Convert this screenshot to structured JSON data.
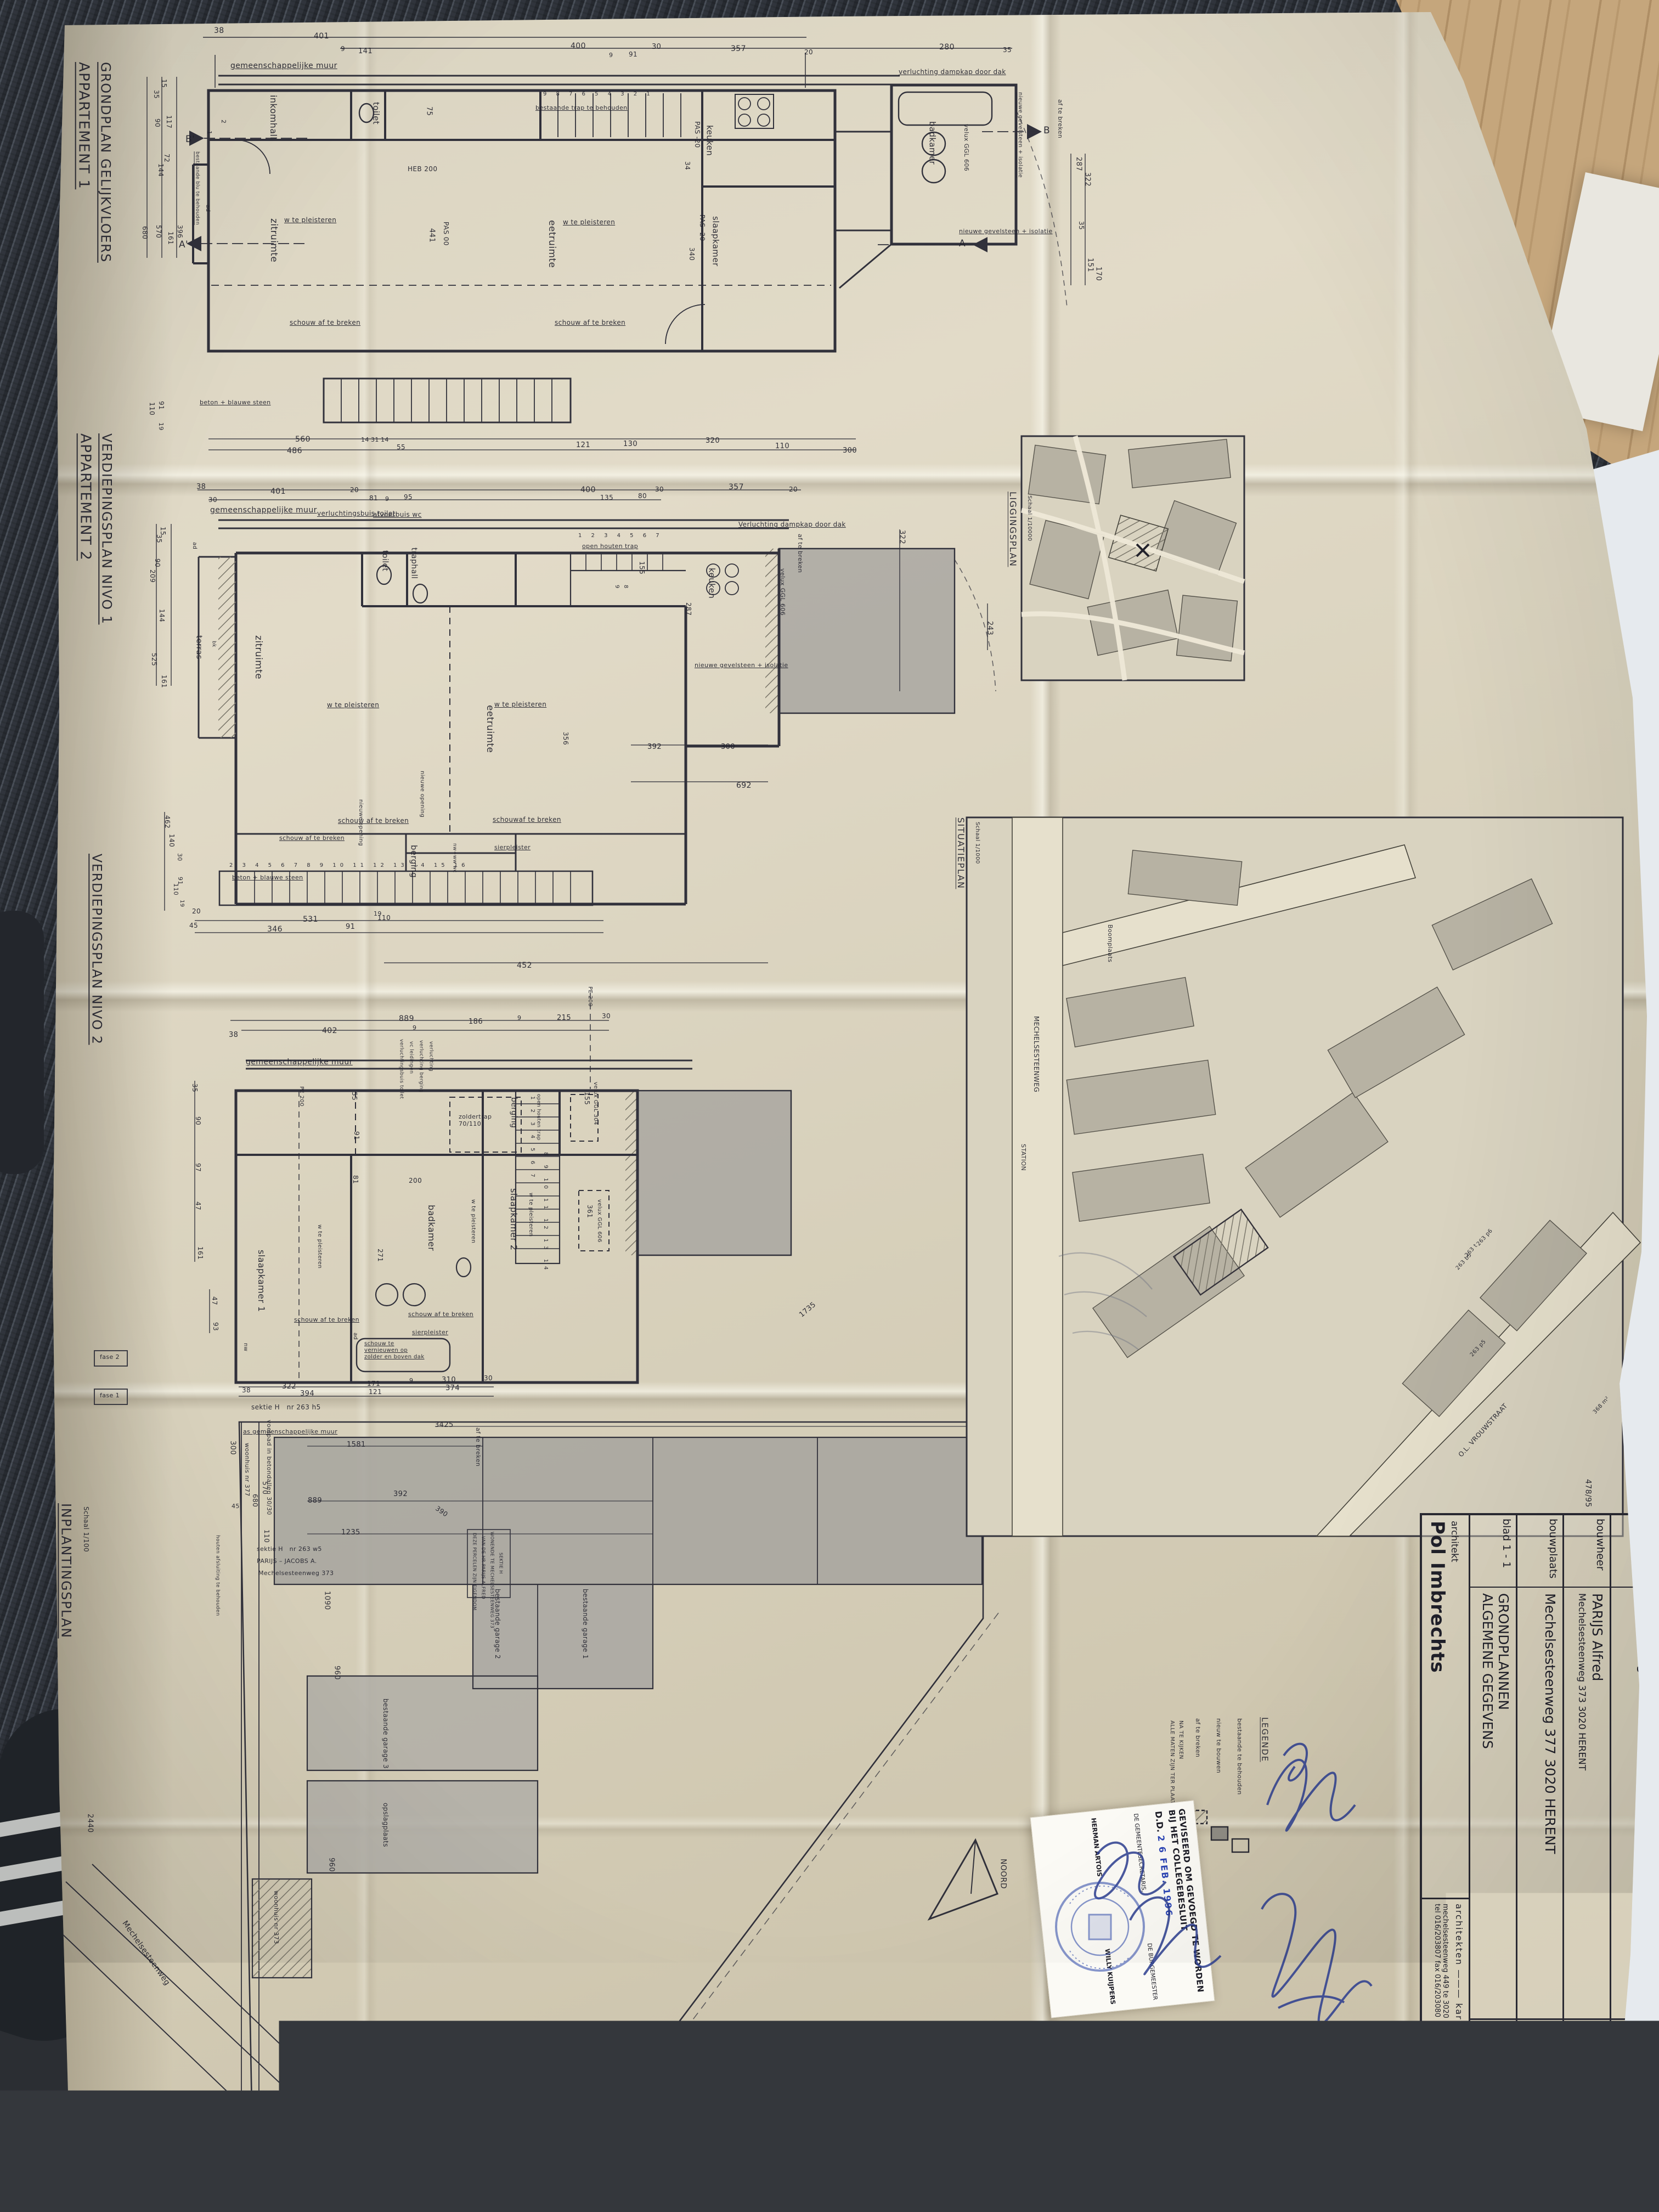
{
  "ap1": {
    "title1": "APPARTEMENT 1",
    "title2": "GRONDPLAN GELIJKVLOERS",
    "labels": {
      "muur": "gemeenschappelijke muur",
      "inkomhall": "inkomhall",
      "toilet": "toilet",
      "zitruimte": "zitruimte",
      "eetruimte": "eetruimte",
      "keuken": "keuken",
      "slaapkamer": "slaapkamer",
      "badkamer": "badkamer",
      "wtp1": "w te pleisteren",
      "wtp2": "w te pleisteren",
      "schouw1": "schouw af te breken",
      "schouw2": "schouw af te breken",
      "trapnote": "bestaande trap te behouden",
      "stairdigits": "9 8 7 6 5 4 3 2 1",
      "heb": "HEB 200",
      "pas00": "PAS 00",
      "pas20a": "PAS -20",
      "pas20b": "PAS -20",
      "verlucht": "verluchting dampkap door dak",
      "velux": "velux GGL 606",
      "ngi1": "nieuwe gevelsteen + isolatie",
      "ngi2": "nieuwe gevelsteen + isolatie",
      "aft": "af te breken",
      "beton": "beton + blauwe steen",
      "bestblu": "bestaande blu te behouden",
      "ad": "ad",
      "mB1": "B'",
      "mB2": "B",
      "mA1": "A'",
      "mA2": "A",
      "n1": "1",
      "n2": "2",
      "d75": "75",
      "d441": "441",
      "d340": "340",
      "d34": "34",
      "t38": "38",
      "t401": "401",
      "t9a": "9",
      "t141": "141",
      "t400": "400",
      "t30": "30",
      "t91": "91",
      "t9b": "9",
      "t357": "357",
      "t20": "20",
      "t280": "280",
      "t35": "35",
      "l15": "15",
      "l35": "35",
      "l90": "90",
      "l117": "117",
      "l72": "72",
      "l144": "144",
      "l396": "396",
      "l161": "161",
      "l570": "570",
      "l680": "680",
      "l110": "110",
      "l91": "91",
      "l19": "19",
      "b560": "560",
      "b486": "486",
      "b14a": "14",
      "b31": "31",
      "b14b": "14",
      "b55": "55",
      "b121": "121",
      "b130": "130",
      "b320": "320",
      "b110": "110",
      "b300": "300",
      "r287": "287",
      "r322": "322",
      "r35": "35",
      "r151": "151",
      "r170": "170"
    }
  },
  "nivo1": {
    "title1": "APPARTEMENT 2",
    "title2": "VERDIEPINGSPLAN NIVO 1",
    "labels": {
      "muur": "gemeenschappelijke muur",
      "vbt": "verluchtingsbuis toilet",
      "avw": "afvoerbuis wc",
      "terras": "terras",
      "zitruimte": "zitruimte",
      "eetruimte": "eetruimte",
      "toilet": "toilet",
      "traphall": "traphall",
      "keuken": "keuken",
      "berging": "berging",
      "wtp1": "w te pleisteren",
      "wtp2": "w te pleisteren",
      "opentrap": "open houten trap",
      "s17": "1 2 3 4 5 6 7",
      "s8": "8",
      "s9": "9",
      "verlucht": "Verluchting dampkap door dak",
      "velux": "velux GGL 606",
      "aft": "af te breken",
      "ngi": "nieuwe gevelsteen + isolatie",
      "sier": "sierpleister",
      "schouw1": "schouw af te breken",
      "schouw2": "schouwaf te breken",
      "schouw3": "schouw af te breken",
      "nop1": "nieuwe opening",
      "nop2": "nieuwe opening",
      "nwww": "nw+ww wc",
      "beton": "beton + blauwe steen",
      "s216": "2 3 4 5 6 7 8 9 10 11 12 13 14 15 16",
      "ad": "ad",
      "bk": "bk",
      "d155": "155",
      "d287": "287",
      "d356": "356",
      "t38": "38",
      "t30a": "30",
      "t401": "401",
      "t20a": "20",
      "t81": "81",
      "t9a": "9",
      "t95": "95",
      "t400": "400",
      "t135": "135",
      "t80": "80",
      "t30b": "30",
      "t357": "357",
      "t20b": "20",
      "l15": "15",
      "l35": "35",
      "l90": "90",
      "l209": "209",
      "l144": "144",
      "l525": "525",
      "l161": "161",
      "l462": "462",
      "l140": "140",
      "l30": "30",
      "l91": "91",
      "l110": "110",
      "l19": "19",
      "b20": "20",
      "b45": "45",
      "b531": "531",
      "b346": "346",
      "b91": "91",
      "b19": "19",
      "b110": "110",
      "b452": "452",
      "b392": "392",
      "b300": "300",
      "b692": "692",
      "r322": "322",
      "r243": "243"
    }
  },
  "nivo2": {
    "title1": "VERDIEPINGSPLAN NIVO 2",
    "labels": {
      "muur": "gemeenschappelijke muur",
      "slaap1": "slaapkamer 1",
      "badkamer": "badkamer",
      "slaap2": "slaapkamer 2",
      "berging": "berging",
      "vbt": "verluchtingsbuis toilet",
      "vcl": "vc leidingen",
      "vbg": "verluchting berging",
      "verl": "verluchting",
      "zold": "zoldertrap 70/110",
      "opentrap": "open houten trap",
      "s17": "1 2 3 4 5 6 7",
      "s814": "8 9 10 11 12 13 14",
      "v304": "velux GGL 304",
      "v606": "velux GGL 606",
      "pe1": "PE 200",
      "pe2": "PE 200",
      "wtp1": "w te pleisteren",
      "wtp2": "w te pleisteren",
      "wtp3": "w te pleisteren",
      "schouw1": "schouw af te breken",
      "schouw2": "schouw af te breken",
      "sier": "sierpleister",
      "svern": "schouw te vernieuwen op zolder en boven dak",
      "ad": "ad",
      "nw": "nw",
      "d155": "155",
      "d200": "200",
      "d271": "271",
      "d361": "361",
      "t889": "889",
      "t9a": "9",
      "t402": "402",
      "t38": "38",
      "t186": "186",
      "t9b": "9",
      "t215": "215",
      "t30": "30",
      "l35": "35",
      "l90": "90",
      "l97": "97",
      "l47": "47",
      "l161": "161",
      "l47b": "47",
      "l93": "93",
      "l55": "55",
      "l91": "91",
      "l81": "81",
      "b38": "38",
      "b322": "322",
      "b394": "394",
      "b171": "171",
      "b121": "121",
      "b9": "9",
      "b310": "310",
      "b374": "374",
      "b30": "30"
    }
  },
  "inplant": {
    "title": "INPLANTINGSPLAN",
    "scale": "Schaal 1/100",
    "labels": {
      "sektieh5": "sektie H   nr 263 h5",
      "voetpad": "voetpad in betondallen 30/30",
      "asmuur": "as gemeenschappelijke muur",
      "woon377": "woonhuis nr 377",
      "aft": "af te breken",
      "nd1": "DEZE PERCELEN ZIJN EIGENDOM",
      "nd2": "VAN DE HR PARIJS ALFRED",
      "nd3": "WONENDE TE MECHELSESTEENWEG 373",
      "nd4": "SEKTIE H",
      "sw5": "sektie H   nr 263 w5",
      "pj": "PARIJS – JACOBS A.",
      "m373": "Mechelsesteenweg 373",
      "houten": "houten afsluiting te behouden",
      "g1": "bestaande garage 1",
      "g2": "bestaande garage 2",
      "g3": "bestaande garage 3",
      "ops": "opslagplaats",
      "woon373": "woonhuis nr 373",
      "b6": "sektie H  nr 263 b6",
      "fayt": "FAYT – DEGREEF A.",
      "fase1": "fase 1",
      "fase2": "fase 2",
      "street": "Mechelsesteenweg",
      "d300": "300",
      "d3425": "3425",
      "d1581": "1581",
      "d392": "392",
      "d889": "889",
      "d1235": "1235",
      "d570": "570",
      "d680": "680",
      "d110": "110",
      "d45": "45",
      "d390": "390",
      "d960a": "960",
      "d960b": "960",
      "d2440": "2440",
      "d1090": "1090",
      "d1735": "1735"
    }
  },
  "ligg": {
    "title": "LIGGINGSPLAN",
    "scale": "Schaal 1/10000"
  },
  "situ": {
    "title": "SITUATIEPLAN",
    "scale": "Schaal 1/1000",
    "labels": {
      "mech": "MECHELSESTEENWEG",
      "boom": "Boomplaats",
      "olv": "O.L. VROUWSTRAAT",
      "station": "STATION",
      "p1": "263 p6",
      "p2": "263 t",
      "p3": "263 b5",
      "p4": "263 p5",
      "m368": "368 m²"
    }
  },
  "legend": {
    "title": "LEGENDE",
    "i1": "bestaande te behouden",
    "i2": "nieuw te bouwen",
    "i3": "af te breken",
    "note1": "ALLE MATEN ZIJN TER PLAATSE",
    "note2": "NA TE KIJKEN"
  },
  "tb": {
    "r1l": "ontwerp",
    "r1v": "Verbouwing",
    "r1rl": "schaal",
    "r1rv": "2 %",
    "r2l": "bouwheer",
    "r2v": "PARIJS Alfred",
    "r2v2": "Mechelsesteenweg 373   3020 HERENT",
    "r2r": "maten in cm s'",
    "r3l": "bouwplaats",
    "r3v": "Mechelsesteenweg 377    3020 HERENT",
    "r3rl": "tekenaar",
    "r3rv": "PETER",
    "r4l": "blad 1 - 1",
    "r4v": "GRONDPLANNEN",
    "r4v2": "ALGEMENE GEGEVENS",
    "r4rl": "datum",
    "r4rv": "10/01/1994",
    "r5l": "architekt",
    "r5v": "Pol Imbrechts",
    "brand1": "architekten",
    "brand2": "karro",
    "f1": "mechelsesteenweg 449   te 3020 Herent",
    "f2": "tel 016/203807      fax 016/203080"
  },
  "stamp": {
    "l1": "GEVISEERD OM GEVOEGD TE WORDEN",
    "l2": "BIJ HET COLLEGEBESLUIT",
    "dd": "D.D.",
    "date": "2 6 FEB. 1996",
    "c1": "DE GEMEENTESECRETARIS,",
    "c2": "DE BURGEMEESTER",
    "n1": "HERMAN ARTOIS",
    "n2": "WILLY KUIJPERS"
  },
  "misc": {
    "noord": "NOORD",
    "pencil": "478/95"
  }
}
